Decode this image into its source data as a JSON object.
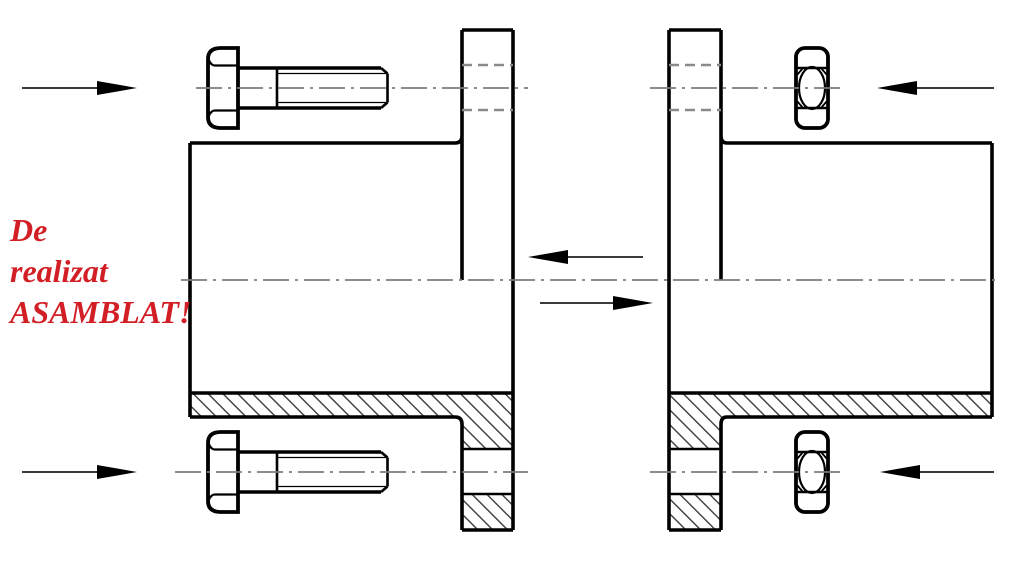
{
  "annotation": {
    "line1": "De",
    "line2": "realizat",
    "line3": "ASAMBLAT!",
    "color": "#d21f26"
  },
  "drawing": {
    "type": "technical-assembly-drawing",
    "parts": [
      "left-flanged-pipe-half-section",
      "right-flanged-pipe-half-section",
      "hex-bolt-top-left",
      "hex-bolt-bottom-left",
      "hex-nut-top-right",
      "hex-nut-bottom-right"
    ],
    "arrows": [
      "assembly-arrow-top-left-right",
      "assembly-arrow-bottom-left-right",
      "assembly-arrow-top-right-left",
      "assembly-arrow-bottom-right-left",
      "assembly-arrow-center-left",
      "assembly-arrow-center-right"
    ],
    "colors": {
      "background": "#ffffff",
      "outline": "#000000",
      "centerline": "#7c7c7c",
      "hidden_line": "#8a8a8a",
      "hatch": "#2e2e2e",
      "annotation": "#d21f26"
    }
  }
}
